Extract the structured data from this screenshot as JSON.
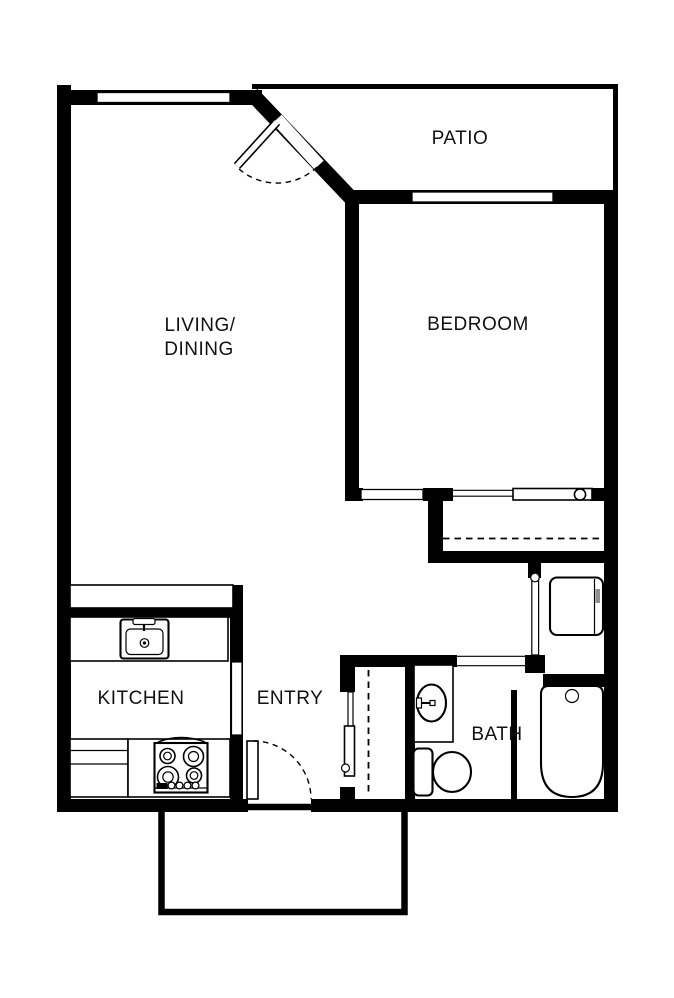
{
  "title": "One-bedroom apartment floor plan",
  "colors": {
    "wall": "#000000",
    "background": "#ffffff",
    "label": "#111111",
    "appliance_handle": "#909090"
  },
  "rooms": {
    "patio": {
      "label": "PATIO"
    },
    "bedroom": {
      "label": "BEDROOM"
    },
    "living_dining": {
      "line1": "LIVING/",
      "line2": "DINING"
    },
    "kitchen": {
      "label": "KITCHEN"
    },
    "entry": {
      "label": "ENTRY"
    },
    "bath": {
      "label": "BATH"
    }
  },
  "fixtures": {
    "kitchen_sink": "kitchen-sink",
    "range": "four-burner-range",
    "base_cabinet": "base-cabinet",
    "breakfast_bar": "pass-through-counter",
    "vanity_sink": "bathroom-vanity-sink",
    "toilet": "toilet",
    "bathtub": "bathtub",
    "water_heater": "water-heater",
    "entry_door": "entry-swing-door",
    "patio_door": "patio-swing-door",
    "bedroom_closet_door": "sliding-closet-door",
    "entry_closet_door": "bypass-closet-door",
    "utility_door": "utility-closet-door",
    "closet_rod": "closet-rod-dashed",
    "stoop": "entry-stoop"
  }
}
